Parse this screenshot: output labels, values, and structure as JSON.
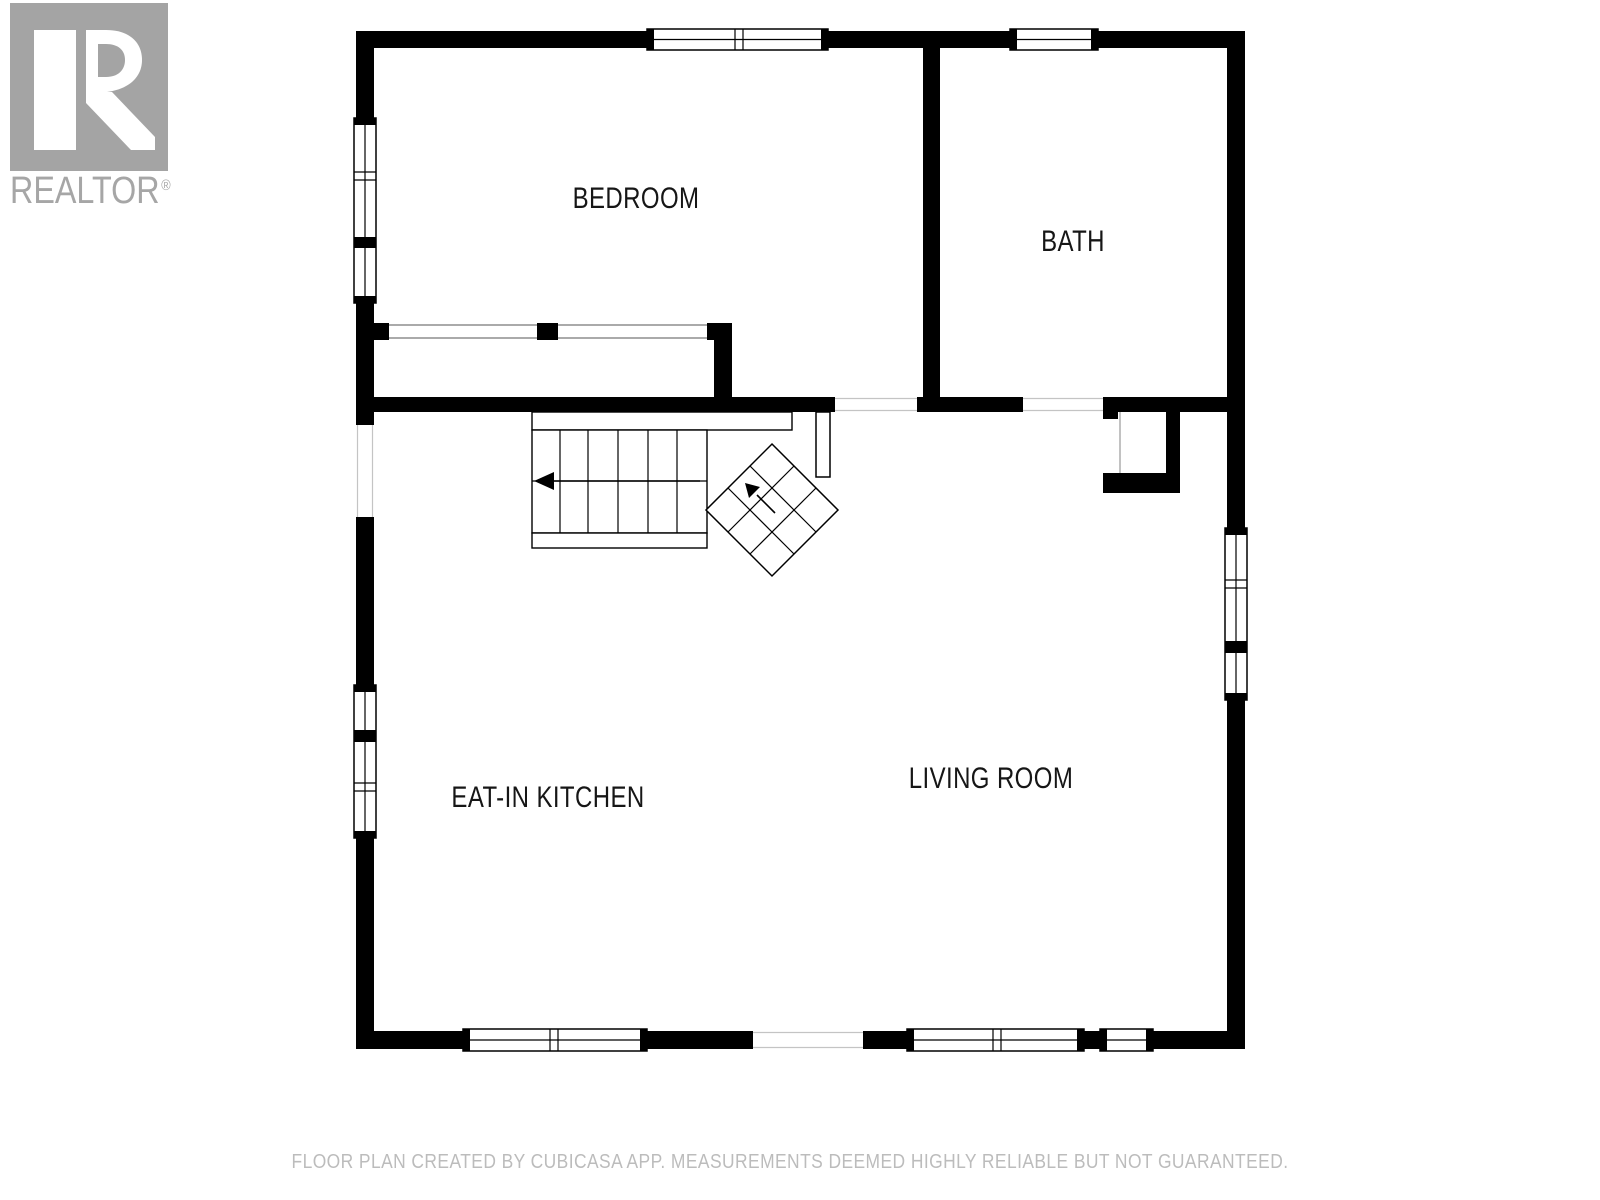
{
  "logo": {
    "brand": "REALTOR",
    "registered": "®",
    "box_color": "#a4a4a4",
    "letter_color": "#ffffff",
    "text_color": "#a6a6a6"
  },
  "footer": {
    "text": "FLOOR PLAN CREATED BY CUBICASA APP. MEASUREMENTS DEEMED HIGHLY RELIABLE BUT NOT GUARANTEED.",
    "color": "#bcbcbc"
  },
  "rooms": [
    {
      "label": "BEDROOM",
      "cx": 636,
      "cy": 199
    },
    {
      "label": "BATH",
      "cx": 1073,
      "cy": 242
    },
    {
      "label": "EAT-IN KITCHEN",
      "cx": 548,
      "cy": 798
    },
    {
      "label": "LIVING ROOM",
      "cx": 991,
      "cy": 779
    }
  ],
  "plan": {
    "wall_color": "#000000",
    "window_fill": "#ffffff",
    "thin_line_color": "#c4c4c4",
    "door_line_color": "#777777",
    "primitives": [
      {
        "t": "rect",
        "n": "wall-top-left",
        "x": 356,
        "y": 31,
        "w": 291,
        "h": 17,
        "f": "#000000"
      },
      {
        "t": "rect",
        "n": "wall-top-mid",
        "x": 828,
        "y": 31,
        "w": 182,
        "h": 17,
        "f": "#000000"
      },
      {
        "t": "rect",
        "n": "wall-top-right",
        "x": 1098,
        "y": 31,
        "w": 147,
        "h": 17,
        "f": "#000000"
      },
      {
        "t": "rect",
        "n": "wall-left-1",
        "x": 356,
        "y": 31,
        "w": 18,
        "h": 87,
        "f": "#000000"
      },
      {
        "t": "rect",
        "n": "wall-left-2",
        "x": 356,
        "y": 303,
        "w": 18,
        "h": 122,
        "f": "#000000"
      },
      {
        "t": "rect",
        "n": "wall-left-3",
        "x": 356,
        "y": 517,
        "w": 18,
        "h": 168,
        "f": "#000000"
      },
      {
        "t": "rect",
        "n": "wall-left-4",
        "x": 356,
        "y": 838,
        "w": 18,
        "h": 211,
        "f": "#000000"
      },
      {
        "t": "rect",
        "n": "wall-right-1",
        "x": 1227,
        "y": 31,
        "w": 18,
        "h": 497,
        "f": "#000000"
      },
      {
        "t": "rect",
        "n": "wall-right-2",
        "x": 1227,
        "y": 700,
        "w": 18,
        "h": 349,
        "f": "#000000"
      },
      {
        "t": "rect",
        "n": "wall-bottom-1",
        "x": 356,
        "y": 1031,
        "w": 107,
        "h": 18,
        "f": "#000000"
      },
      {
        "t": "rect",
        "n": "wall-bottom-2",
        "x": 647,
        "y": 1031,
        "w": 106,
        "h": 18,
        "f": "#000000"
      },
      {
        "t": "rect",
        "n": "wall-bottom-3",
        "x": 863,
        "y": 1031,
        "w": 44,
        "h": 18,
        "f": "#000000"
      },
      {
        "t": "rect",
        "n": "wall-bottom-jamb",
        "x": 1084,
        "y": 1031,
        "w": 16,
        "h": 18,
        "f": "#000000"
      },
      {
        "t": "rect",
        "n": "wall-bottom-4",
        "x": 1153,
        "y": 1031,
        "w": 92,
        "h": 18,
        "f": "#000000"
      },
      {
        "t": "rect",
        "n": "wall-divider-bed-bath",
        "x": 923,
        "y": 48,
        "w": 17,
        "h": 349,
        "f": "#000000"
      },
      {
        "t": "rect",
        "n": "wall-middle-1",
        "x": 374,
        "y": 397,
        "w": 461,
        "h": 15,
        "f": "#000000"
      },
      {
        "t": "rect",
        "n": "wall-middle-2",
        "x": 917,
        "y": 397,
        "w": 106,
        "h": 15,
        "f": "#000000"
      },
      {
        "t": "rect",
        "n": "wall-middle-3",
        "x": 1103,
        "y": 397,
        "w": 124,
        "h": 15,
        "f": "#000000"
      },
      {
        "t": "rect",
        "n": "closet-wall-stub",
        "x": 374,
        "y": 323,
        "w": 15,
        "h": 17,
        "f": "#000000"
      },
      {
        "t": "rect",
        "n": "closet-wall-mid",
        "x": 537,
        "y": 323,
        "w": 21,
        "h": 17,
        "f": "#000000"
      },
      {
        "t": "rect",
        "n": "closet-wall-corner",
        "x": 707,
        "y": 323,
        "w": 25,
        "h": 17,
        "f": "#000000"
      },
      {
        "t": "rect",
        "n": "closet-wall-right",
        "x": 714,
        "y": 340,
        "w": 18,
        "h": 57,
        "f": "#000000"
      },
      {
        "t": "rect",
        "n": "alcove-stub",
        "x": 1103,
        "y": 412,
        "w": 15,
        "h": 7,
        "f": "#000000"
      },
      {
        "t": "rect",
        "n": "alcove-bottom-wall",
        "x": 1103,
        "y": 473,
        "w": 65,
        "h": 20,
        "f": "#000000"
      },
      {
        "t": "rect",
        "n": "alcove-right-wall",
        "x": 1166,
        "y": 412,
        "w": 14,
        "h": 81,
        "f": "#000000"
      },
      {
        "t": "line",
        "n": "closet-door-line",
        "x1": 389,
        "y1": 325,
        "x2": 537,
        "y2": 325,
        "s": "#777777",
        "sw": 1.3
      },
      {
        "t": "line",
        "n": "closet-door-line",
        "x1": 389,
        "y1": 338,
        "x2": 537,
        "y2": 338,
        "s": "#777777",
        "sw": 1.3
      },
      {
        "t": "line",
        "n": "closet-door-line",
        "x1": 558,
        "y1": 325,
        "x2": 707,
        "y2": 325,
        "s": "#777777",
        "sw": 1.3
      },
      {
        "t": "line",
        "n": "closet-door-line",
        "x1": 558,
        "y1": 338,
        "x2": 707,
        "y2": 338,
        "s": "#777777",
        "sw": 1.3
      },
      {
        "t": "line",
        "n": "opening-line-hall",
        "x1": 835,
        "y1": 398.5,
        "x2": 917,
        "y2": 398.5,
        "s": "#c4c4c4",
        "sw": 1.2
      },
      {
        "t": "line",
        "n": "opening-line-hall",
        "x1": 835,
        "y1": 410.5,
        "x2": 917,
        "y2": 410.5,
        "s": "#c4c4c4",
        "sw": 1.2
      },
      {
        "t": "line",
        "n": "opening-line-bath-door",
        "x1": 1023,
        "y1": 398.5,
        "x2": 1103,
        "y2": 398.5,
        "s": "#c4c4c4",
        "sw": 1.2
      },
      {
        "t": "line",
        "n": "opening-line-bath-door",
        "x1": 1023,
        "y1": 410.5,
        "x2": 1103,
        "y2": 410.5,
        "s": "#c4c4c4",
        "sw": 1.2
      },
      {
        "t": "line",
        "n": "opening-line-left",
        "x1": 357.5,
        "y1": 425,
        "x2": 357.5,
        "y2": 517,
        "s": "#c4c4c4",
        "sw": 1.2
      },
      {
        "t": "line",
        "n": "opening-line-left",
        "x1": 372.5,
        "y1": 425,
        "x2": 372.5,
        "y2": 517,
        "s": "#c4c4c4",
        "sw": 1.2
      },
      {
        "t": "line",
        "n": "opening-line-bottom",
        "x1": 753,
        "y1": 1032.5,
        "x2": 863,
        "y2": 1032.5,
        "s": "#c4c4c4",
        "sw": 1.2
      },
      {
        "t": "line",
        "n": "opening-line-bottom",
        "x1": 753,
        "y1": 1047.5,
        "x2": 863,
        "y2": 1047.5,
        "s": "#c4c4c4",
        "sw": 1.2
      },
      {
        "t": "line",
        "n": "alcove-open-line",
        "x1": 1120,
        "y1": 412,
        "x2": 1120,
        "y2": 473,
        "s": "#999999",
        "sw": 1.2
      },
      {
        "t": "rect",
        "n": "window-top-bedroom",
        "x": 647,
        "y": 29,
        "w": 181,
        "h": 21,
        "f": "#ffffff",
        "s": "#000000",
        "sw": 1.5
      },
      {
        "t": "line",
        "n": "window-glass-line",
        "x1": 647,
        "y1": 39.5,
        "x2": 828,
        "y2": 39.5,
        "s": "#000000",
        "sw": 1.2
      },
      {
        "t": "rect",
        "n": "window-cap",
        "x": 647,
        "y": 29,
        "w": 7,
        "h": 21,
        "f": "#000000"
      },
      {
        "t": "rect",
        "n": "window-cap",
        "x": 821,
        "y": 29,
        "w": 7,
        "h": 21,
        "f": "#000000"
      },
      {
        "t": "line",
        "n": "window-mullion",
        "x1": 735,
        "y1": 29,
        "x2": 735,
        "y2": 50,
        "s": "#000000",
        "sw": 1.2
      },
      {
        "t": "line",
        "n": "window-mullion",
        "x1": 743,
        "y1": 29,
        "x2": 743,
        "y2": 50,
        "s": "#000000",
        "sw": 1.2
      },
      {
        "t": "rect",
        "n": "window-top-bath",
        "x": 1010,
        "y": 29,
        "w": 88,
        "h": 21,
        "f": "#ffffff",
        "s": "#000000",
        "sw": 1.5
      },
      {
        "t": "line",
        "n": "window-glass-line",
        "x1": 1010,
        "y1": 39.5,
        "x2": 1098,
        "y2": 39.5,
        "s": "#000000",
        "sw": 1.2
      },
      {
        "t": "rect",
        "n": "window-cap",
        "x": 1010,
        "y": 29,
        "w": 7,
        "h": 21,
        "f": "#000000"
      },
      {
        "t": "rect",
        "n": "window-cap",
        "x": 1091,
        "y": 29,
        "w": 7,
        "h": 21,
        "f": "#000000"
      },
      {
        "t": "rect",
        "n": "window-bottom-kitchen",
        "x": 463,
        "y": 1029,
        "w": 184,
        "h": 22,
        "f": "#ffffff",
        "s": "#000000",
        "sw": 1.5
      },
      {
        "t": "line",
        "n": "window-glass-line",
        "x1": 463,
        "y1": 1040,
        "x2": 647,
        "y2": 1040,
        "s": "#000000",
        "sw": 1.2
      },
      {
        "t": "rect",
        "n": "window-cap",
        "x": 463,
        "y": 1029,
        "w": 7,
        "h": 22,
        "f": "#000000"
      },
      {
        "t": "rect",
        "n": "window-cap",
        "x": 640,
        "y": 1029,
        "w": 7,
        "h": 22,
        "f": "#000000"
      },
      {
        "t": "line",
        "n": "window-mullion",
        "x1": 550,
        "y1": 1029,
        "x2": 550,
        "y2": 1051,
        "s": "#000000",
        "sw": 1.2
      },
      {
        "t": "line",
        "n": "window-mullion",
        "x1": 558,
        "y1": 1029,
        "x2": 558,
        "y2": 1051,
        "s": "#000000",
        "sw": 1.2
      },
      {
        "t": "rect",
        "n": "window-bottom-living",
        "x": 907,
        "y": 1029,
        "w": 177,
        "h": 22,
        "f": "#ffffff",
        "s": "#000000",
        "sw": 1.5
      },
      {
        "t": "line",
        "n": "window-glass-line",
        "x1": 907,
        "y1": 1040,
        "x2": 1084,
        "y2": 1040,
        "s": "#000000",
        "sw": 1.2
      },
      {
        "t": "rect",
        "n": "window-cap",
        "x": 907,
        "y": 1029,
        "w": 7,
        "h": 22,
        "f": "#000000"
      },
      {
        "t": "rect",
        "n": "window-cap",
        "x": 1077,
        "y": 1029,
        "w": 7,
        "h": 22,
        "f": "#000000"
      },
      {
        "t": "line",
        "n": "window-mullion",
        "x1": 993,
        "y1": 1029,
        "x2": 993,
        "y2": 1051,
        "s": "#000000",
        "sw": 1.2
      },
      {
        "t": "line",
        "n": "window-mullion",
        "x1": 1001,
        "y1": 1029,
        "x2": 1001,
        "y2": 1051,
        "s": "#000000",
        "sw": 1.2
      },
      {
        "t": "rect",
        "n": "window-bottom-small",
        "x": 1100,
        "y": 1029,
        "w": 53,
        "h": 22,
        "f": "#ffffff",
        "s": "#000000",
        "sw": 1.5
      },
      {
        "t": "line",
        "n": "window-glass-line",
        "x1": 1100,
        "y1": 1040,
        "x2": 1153,
        "y2": 1040,
        "s": "#000000",
        "sw": 1.2
      },
      {
        "t": "rect",
        "n": "window-cap",
        "x": 1100,
        "y": 1029,
        "w": 7,
        "h": 22,
        "f": "#000000"
      },
      {
        "t": "rect",
        "n": "window-cap",
        "x": 1146,
        "y": 1029,
        "w": 7,
        "h": 22,
        "f": "#000000"
      },
      {
        "t": "rect",
        "n": "window-left-bedroom",
        "x": 354,
        "y": 118,
        "w": 22,
        "h": 185,
        "f": "#ffffff",
        "s": "#000000",
        "sw": 1.5
      },
      {
        "t": "line",
        "n": "window-glass-line",
        "x1": 365,
        "y1": 118,
        "x2": 365,
        "y2": 303,
        "s": "#000000",
        "sw": 1.2
      },
      {
        "t": "rect",
        "n": "window-cap",
        "x": 354,
        "y": 118,
        "w": 22,
        "h": 7,
        "f": "#000000"
      },
      {
        "t": "rect",
        "n": "window-cap",
        "x": 354,
        "y": 296,
        "w": 22,
        "h": 7,
        "f": "#000000"
      },
      {
        "t": "line",
        "n": "window-sill",
        "x1": 354,
        "y1": 172,
        "x2": 376,
        "y2": 172,
        "s": "#000000",
        "sw": 1.2
      },
      {
        "t": "line",
        "n": "window-sill",
        "x1": 354,
        "y1": 180,
        "x2": 376,
        "y2": 180,
        "s": "#000000",
        "sw": 1.2
      },
      {
        "t": "rect",
        "n": "window-separator",
        "x": 354,
        "y": 237,
        "w": 22,
        "h": 11,
        "f": "#000000"
      },
      {
        "t": "rect",
        "n": "window-left-kitchen",
        "x": 354,
        "y": 685,
        "w": 22,
        "h": 153,
        "f": "#ffffff",
        "s": "#000000",
        "sw": 1.5
      },
      {
        "t": "line",
        "n": "window-glass-line",
        "x1": 365,
        "y1": 685,
        "x2": 365,
        "y2": 838,
        "s": "#000000",
        "sw": 1.2
      },
      {
        "t": "rect",
        "n": "window-cap",
        "x": 354,
        "y": 685,
        "w": 22,
        "h": 7,
        "f": "#000000"
      },
      {
        "t": "rect",
        "n": "window-cap",
        "x": 354,
        "y": 831,
        "w": 22,
        "h": 7,
        "f": "#000000"
      },
      {
        "t": "line",
        "n": "window-sill",
        "x1": 354,
        "y1": 783,
        "x2": 376,
        "y2": 783,
        "s": "#000000",
        "sw": 1.2
      },
      {
        "t": "line",
        "n": "window-sill",
        "x1": 354,
        "y1": 791,
        "x2": 376,
        "y2": 791,
        "s": "#000000",
        "sw": 1.2
      },
      {
        "t": "rect",
        "n": "window-separator",
        "x": 354,
        "y": 730,
        "w": 22,
        "h": 12,
        "f": "#000000"
      },
      {
        "t": "rect",
        "n": "window-right-living",
        "x": 1225,
        "y": 528,
        "w": 22,
        "h": 172,
        "f": "#ffffff",
        "s": "#000000",
        "sw": 1.5
      },
      {
        "t": "line",
        "n": "window-glass-line",
        "x1": 1236,
        "y1": 528,
        "x2": 1236,
        "y2": 700,
        "s": "#000000",
        "sw": 1.2
      },
      {
        "t": "rect",
        "n": "window-cap",
        "x": 1225,
        "y": 528,
        "w": 22,
        "h": 7,
        "f": "#000000"
      },
      {
        "t": "rect",
        "n": "window-cap",
        "x": 1225,
        "y": 693,
        "w": 22,
        "h": 7,
        "f": "#000000"
      },
      {
        "t": "line",
        "n": "window-sill",
        "x1": 1225,
        "y1": 580,
        "x2": 1247,
        "y2": 580,
        "s": "#000000",
        "sw": 1.2
      },
      {
        "t": "line",
        "n": "window-sill",
        "x1": 1225,
        "y1": 588,
        "x2": 1247,
        "y2": 588,
        "s": "#000000",
        "sw": 1.2
      },
      {
        "t": "rect",
        "n": "window-separator",
        "x": 1225,
        "y": 641,
        "w": 22,
        "h": 12,
        "f": "#000000"
      },
      {
        "t": "rect",
        "n": "door-leaf",
        "x": 816,
        "y": 412,
        "w": 14,
        "h": 65,
        "f": "#ffffff",
        "s": "#000000",
        "sw": 1.5
      },
      {
        "t": "rect",
        "n": "stair-landing",
        "x": 532,
        "y": 412,
        "w": 260,
        "h": 18,
        "f": "#ffffff",
        "s": "#000000",
        "sw": 1.4
      },
      {
        "t": "rect",
        "n": "stair-treads",
        "x": 532,
        "y": 430,
        "w": 175,
        "h": 103,
        "f": "#ffffff",
        "s": "#000000",
        "sw": 1.4
      },
      {
        "t": "line",
        "n": "stair-tread-line",
        "x1": 560,
        "y1": 430,
        "x2": 560,
        "y2": 533,
        "s": "#000000",
        "sw": 1.2
      },
      {
        "t": "line",
        "n": "stair-tread-line",
        "x1": 588,
        "y1": 430,
        "x2": 588,
        "y2": 533,
        "s": "#000000",
        "sw": 1.2
      },
      {
        "t": "line",
        "n": "stair-tread-line",
        "x1": 618,
        "y1": 430,
        "x2": 618,
        "y2": 533,
        "s": "#000000",
        "sw": 1.2
      },
      {
        "t": "line",
        "n": "stair-tread-line",
        "x1": 648,
        "y1": 430,
        "x2": 648,
        "y2": 533,
        "s": "#000000",
        "sw": 1.2
      },
      {
        "t": "line",
        "n": "stair-tread-line",
        "x1": 677,
        "y1": 430,
        "x2": 677,
        "y2": 533,
        "s": "#000000",
        "sw": 1.2
      },
      {
        "t": "line",
        "n": "stair-mid-line",
        "x1": 532,
        "y1": 481,
        "x2": 707,
        "y2": 481,
        "s": "#000000",
        "sw": 1.2
      },
      {
        "t": "rect",
        "n": "stair-bottom-step",
        "x": 532,
        "y": 533,
        "w": 175,
        "h": 15,
        "f": "#ffffff",
        "s": "#000000",
        "sw": 1.4
      },
      {
        "t": "line",
        "n": "stair-arrow-shaft",
        "x1": 554,
        "y1": 481,
        "x2": 700,
        "y2": 481,
        "s": "#000000",
        "sw": 1.6
      },
      {
        "t": "poly",
        "n": "stair-arrow-head",
        "pts": "534,481 554,472 554,490",
        "f": "#000000"
      },
      {
        "t": "poly",
        "n": "winder-stairs",
        "pts": "772,444 838,510 772,576 706,510",
        "f": "#ffffff",
        "s": "#000000",
        "sw": 1.5
      },
      {
        "t": "line",
        "n": "winder-line",
        "x1": 728,
        "y1": 488,
        "x2": 794,
        "y2": 554,
        "s": "#000000",
        "sw": 1.2
      },
      {
        "t": "line",
        "n": "winder-line",
        "x1": 750,
        "y1": 466,
        "x2": 816,
        "y2": 532,
        "s": "#000000",
        "sw": 1.2
      },
      {
        "t": "line",
        "n": "winder-line",
        "x1": 794,
        "y1": 466,
        "x2": 728,
        "y2": 532,
        "s": "#000000",
        "sw": 1.2
      },
      {
        "t": "line",
        "n": "winder-line",
        "x1": 816,
        "y1": 488,
        "x2": 750,
        "y2": 554,
        "s": "#000000",
        "sw": 1.2
      },
      {
        "t": "line",
        "n": "winder-arrow-shaft",
        "x1": 775,
        "y1": 513,
        "x2": 757,
        "y2": 495,
        "s": "#000000",
        "sw": 1.6
      },
      {
        "t": "poly",
        "n": "winder-arrow-head",
        "pts": "745,483 760,487 749,498",
        "f": "#000000"
      }
    ]
  }
}
